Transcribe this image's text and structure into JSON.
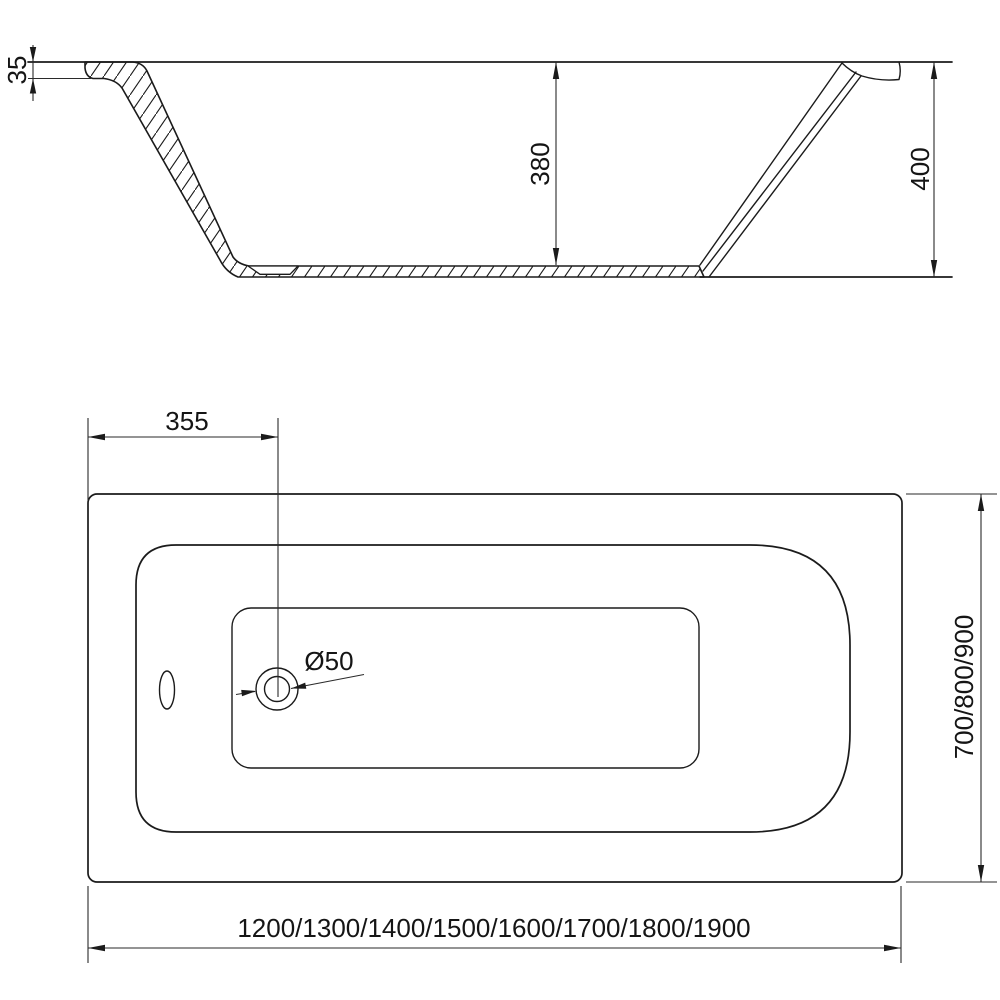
{
  "colors": {
    "background": "#ffffff",
    "line": "#1b1b1b",
    "text": "#151515"
  },
  "side_view": {
    "rim_thickness_label": "35",
    "inner_depth_label": "380",
    "total_height_label": "400"
  },
  "plan_view": {
    "drain_offset_label": "355",
    "drain_diameter_label": "Ø50",
    "width_options_label": "700/800/900",
    "length_options_label": "1200/1300/1400/1500/1600/1700/1800/1900"
  }
}
